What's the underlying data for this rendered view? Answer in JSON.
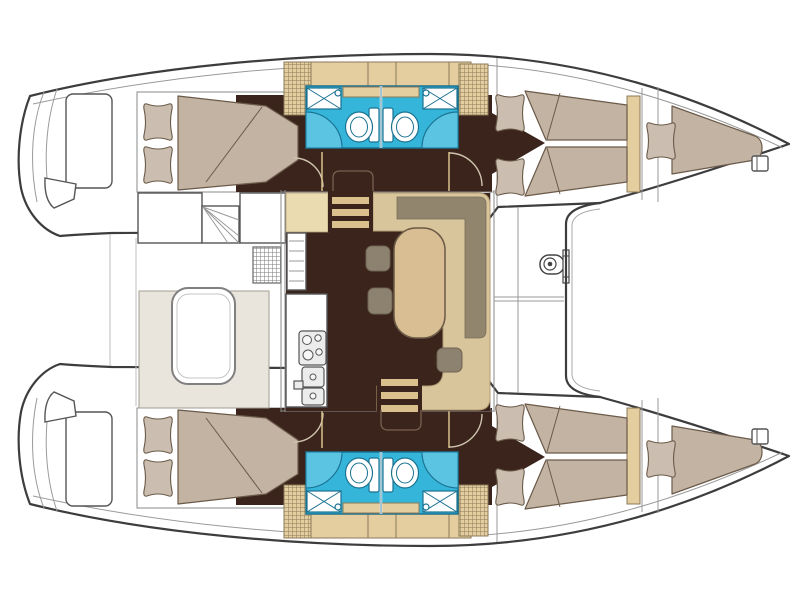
{
  "figure": {
    "kind": "boat-floor-plan",
    "subject": "catamaran-yacht-accommodation-layout",
    "visible_text": []
  },
  "palette": {
    "outline": "#3D3D3D",
    "line_light": "#9A9A9A",
    "floor": "#3A241C",
    "mattress": "#C2B3A2",
    "pillow": "#CBBEB0",
    "bed_line": "#6B5A49",
    "tan": "#D9C59C",
    "table": "#D8BE92",
    "cream": "#EBDBB1",
    "cabinet": "#E4CD9E",
    "cabinet_line": "#8A7A5A",
    "sofa_gray": "#92856E",
    "stool": "#8D8170",
    "bath_blue": "#35B5DA",
    "bath_blue_light": "#5AC4E2",
    "bath_line": "#1B7291",
    "bench": "#E9E5DC",
    "rung": "#D9C08C",
    "door_arc": "#CFC4AE"
  },
  "features": [
    "starboard-hull",
    "port-hull",
    "stern-swim-platforms",
    "aft-cabin-double-bed",
    "bathroom-with-toilet-and-shower",
    "forward-cabin-double-bed",
    "bow-berth",
    "cockpit-table-and-bench",
    "salon-dinette-table",
    "galley-stove-and-sinks",
    "companionway-steps",
    "foredeck",
    "trampoline",
    "anchor-windlass"
  ]
}
